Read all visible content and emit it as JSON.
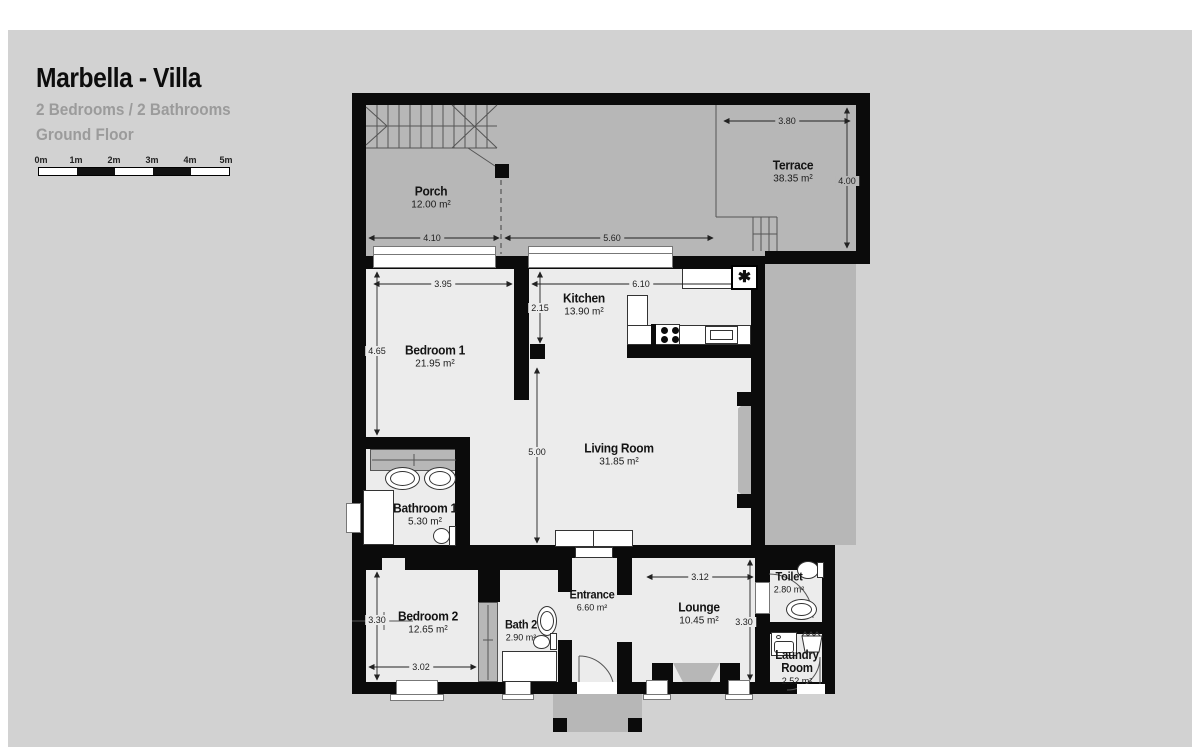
{
  "header": {
    "title": "Marbella - Villa",
    "subtitle": "2 Bedrooms / 2 Bathrooms",
    "floor": "Ground Floor"
  },
  "scale_bar": {
    "labels": [
      "0m",
      "1m",
      "2m",
      "3m",
      "4m",
      "5m"
    ]
  },
  "rooms": {
    "porch": {
      "name": "Porch",
      "area": "12.00 m²"
    },
    "terrace": {
      "name": "Terrace",
      "area": "38.35 m²"
    },
    "kitchen": {
      "name": "Kitchen",
      "area": "13.90 m²"
    },
    "bedroom1": {
      "name": "Bedroom 1",
      "area": "21.95 m²"
    },
    "living_room": {
      "name": "Living Room",
      "area": "31.85 m²"
    },
    "bathroom1": {
      "name": "Bathroom 1",
      "area": "5.30 m²"
    },
    "bedroom2": {
      "name": "Bedroom 2",
      "area": "12.65 m²"
    },
    "bath2": {
      "name": "Bath 2",
      "area": "2.90 m²"
    },
    "entrance": {
      "name": "Entrance",
      "area": "6.60 m²"
    },
    "lounge": {
      "name": "Lounge",
      "area": "10.45 m²"
    },
    "toilet": {
      "name": "Toilet",
      "area": "2.80 m²"
    },
    "laundry_room": {
      "name": "Laundry Room",
      "area": "2.52 m²"
    }
  },
  "dimensions": {
    "terrace_width": "3.80",
    "terrace_depth": "4.00",
    "porch_section_left": "4.10",
    "porch_section_right": "5.60",
    "bedroom1_width": "3.95",
    "bedroom1_depth": "4.65",
    "kitchen_width": "6.10",
    "kitchen_depth": "2.15",
    "living_room_depth": "5.00",
    "bedroom2_depth": "3.30",
    "bedroom2_width": "3.02",
    "lounge_width": "3.12",
    "lounge_depth": "3.30"
  },
  "icons": {
    "heating_symbol": "✱"
  },
  "colors": {
    "canvas": "#d2d2d2",
    "outdoor": "#b7b7b7",
    "room_fill": "#ececec",
    "wall": "#0b0b0b",
    "muted_text": "#9b9b9b"
  }
}
